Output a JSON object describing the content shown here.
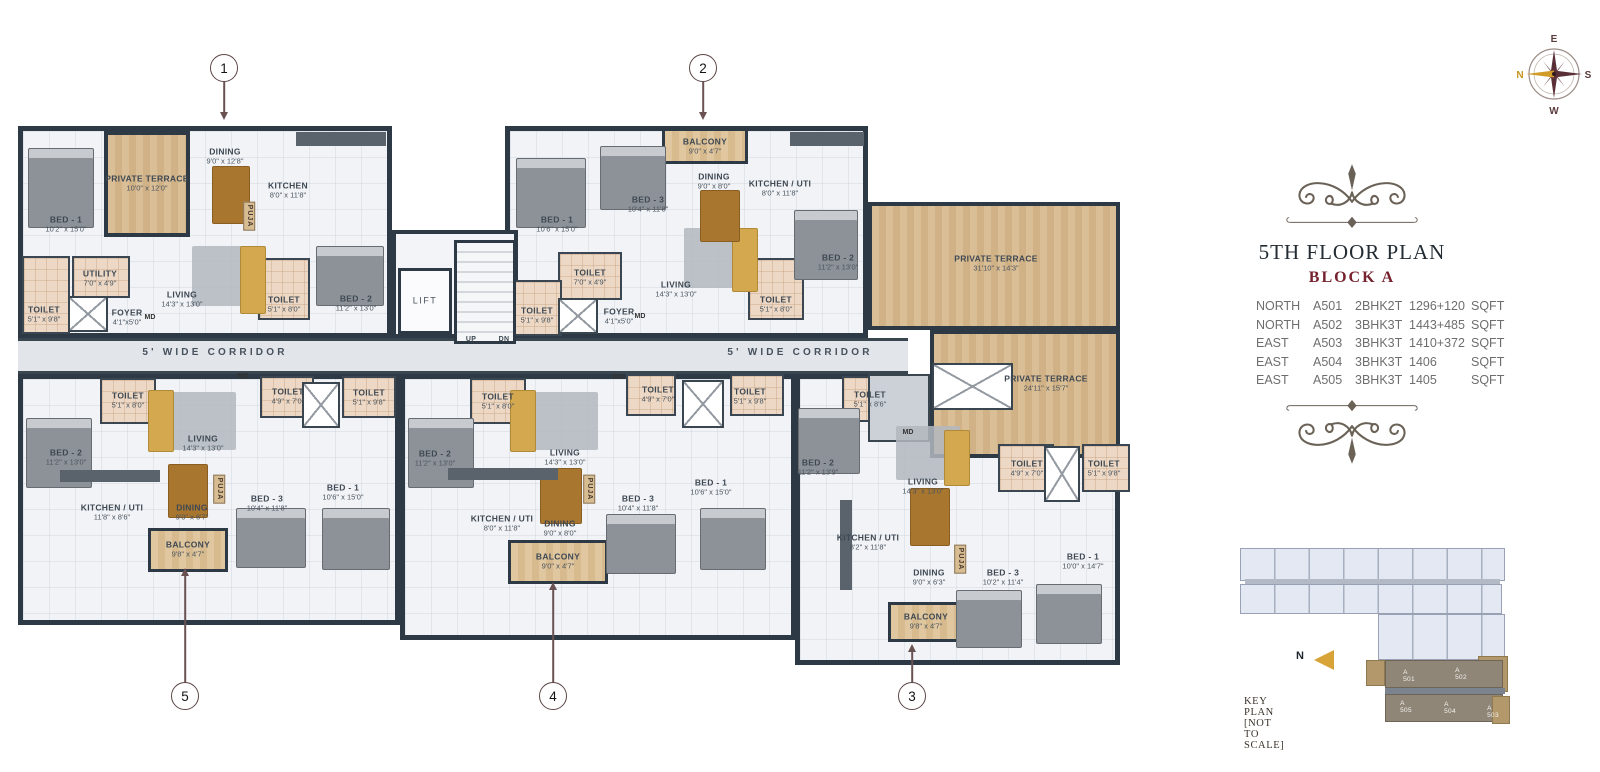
{
  "title": {
    "floor": "5TH FLOOR PLAN",
    "block": "BLOCK A"
  },
  "table": {
    "rows": [
      {
        "dir": "NORTH",
        "unit": "A501",
        "type": "2BHK2T",
        "area": "1296+120",
        "sqft": "SQFT"
      },
      {
        "dir": "NORTH",
        "unit": "A502",
        "type": "3BHK3T",
        "area": "1443+485",
        "sqft": "SQFT"
      },
      {
        "dir": "EAST",
        "unit": "A503",
        "type": "3BHK3T",
        "area": "1410+372",
        "sqft": "SQFT"
      },
      {
        "dir": "EAST",
        "unit": "A504",
        "type": "3BHK3T",
        "area": "1406",
        "sqft": "SQFT"
      },
      {
        "dir": "EAST",
        "unit": "A505",
        "type": "3BHK3T",
        "area": "1405",
        "sqft": "SQFT"
      }
    ]
  },
  "compass": {
    "n": "N",
    "e": "E",
    "s": "S",
    "w": "W"
  },
  "keyplan": {
    "caption": "KEY PLAN  [NOT TO SCALE]",
    "north_label": "N",
    "units": [
      {
        "label": "A 501",
        "x": 1409,
        "y": 676
      },
      {
        "label": "A 502",
        "x": 1461,
        "y": 674
      },
      {
        "label": "A 505",
        "x": 1406,
        "y": 707
      },
      {
        "label": "A 504",
        "x": 1450,
        "y": 708
      },
      {
        "label": "A 503",
        "x": 1493,
        "y": 712
      }
    ]
  },
  "colors": {
    "wall": "#2d3944",
    "terrace": "#d8bc92",
    "maroon": "#76232f",
    "gold": "#d19b2a"
  },
  "callouts": [
    {
      "n": "1",
      "cx": 224,
      "cy": 68,
      "x": 224,
      "y1": 82,
      "y2": 112,
      "head": "down"
    },
    {
      "n": "2",
      "cx": 703,
      "cy": 68,
      "x": 703,
      "y1": 82,
      "y2": 112,
      "head": "down"
    },
    {
      "n": "3",
      "cx": 912,
      "cy": 696,
      "x": 912,
      "y1": 652,
      "y2": 683,
      "head": "up"
    },
    {
      "n": "4",
      "cx": 553,
      "cy": 696,
      "x": 553,
      "y1": 590,
      "y2": 683,
      "head": "up"
    },
    {
      "n": "5",
      "cx": 185,
      "cy": 696,
      "x": 185,
      "y1": 576,
      "y2": 683,
      "head": "up"
    }
  ],
  "plan": {
    "md_text": "MD",
    "puja_text": "PUJA",
    "zones": [
      {
        "t": "unit",
        "x": 18,
        "y": 126,
        "w": 374,
        "h": 212
      },
      {
        "t": "unit",
        "x": 505,
        "y": 126,
        "w": 363,
        "h": 212
      },
      {
        "t": "unit",
        "x": 18,
        "y": 374,
        "w": 382,
        "h": 251
      },
      {
        "t": "unit",
        "x": 400,
        "y": 374,
        "w": 396,
        "h": 266
      },
      {
        "t": "unit",
        "x": 795,
        "y": 374,
        "w": 325,
        "h": 291
      },
      {
        "t": "core",
        "x": 392,
        "y": 230,
        "w": 126,
        "h": 108
      },
      {
        "t": "corridor",
        "x": 18,
        "y": 338,
        "w": 890,
        "h": 36
      },
      {
        "t": "terrace",
        "x": 868,
        "y": 202,
        "w": 252,
        "h": 128
      },
      {
        "t": "terrace",
        "x": 930,
        "y": 330,
        "w": 190,
        "h": 128
      },
      {
        "t": "terrace",
        "x": 104,
        "y": 131,
        "w": 86,
        "h": 106
      },
      {
        "t": "balcony",
        "x": 662,
        "y": 128,
        "w": 86,
        "h": 36
      },
      {
        "t": "balcony",
        "x": 148,
        "y": 528,
        "w": 80,
        "h": 44
      },
      {
        "t": "balcony",
        "x": 508,
        "y": 540,
        "w": 100,
        "h": 44
      },
      {
        "t": "balcony",
        "x": 888,
        "y": 602,
        "w": 76,
        "h": 40
      },
      {
        "t": "toilet",
        "x": 22,
        "y": 256,
        "w": 48,
        "h": 78
      },
      {
        "t": "toilet",
        "x": 72,
        "y": 256,
        "w": 58,
        "h": 42
      },
      {
        "t": "toilet",
        "x": 258,
        "y": 258,
        "w": 52,
        "h": 62
      },
      {
        "t": "toilet",
        "x": 558,
        "y": 252,
        "w": 64,
        "h": 48
      },
      {
        "t": "toilet",
        "x": 510,
        "y": 280,
        "w": 52,
        "h": 56
      },
      {
        "t": "toilet",
        "x": 748,
        "y": 258,
        "w": 56,
        "h": 62
      },
      {
        "t": "toilet",
        "x": 100,
        "y": 378,
        "w": 56,
        "h": 46
      },
      {
        "t": "toilet",
        "x": 260,
        "y": 376,
        "w": 54,
        "h": 42
      },
      {
        "t": "toilet",
        "x": 342,
        "y": 376,
        "w": 54,
        "h": 42
      },
      {
        "t": "toilet",
        "x": 470,
        "y": 378,
        "w": 56,
        "h": 46
      },
      {
        "t": "toilet",
        "x": 626,
        "y": 374,
        "w": 50,
        "h": 42
      },
      {
        "t": "toilet",
        "x": 730,
        "y": 374,
        "w": 54,
        "h": 42
      },
      {
        "t": "toilet",
        "x": 842,
        "y": 376,
        "w": 54,
        "h": 46
      },
      {
        "t": "toilet",
        "x": 998,
        "y": 444,
        "w": 56,
        "h": 48
      },
      {
        "t": "toilet",
        "x": 1082,
        "y": 444,
        "w": 48,
        "h": 48
      },
      {
        "t": "vest",
        "x": 868,
        "y": 374,
        "w": 62,
        "h": 68
      },
      {
        "t": "lift",
        "x": 398,
        "y": 268,
        "w": 54,
        "h": 66
      },
      {
        "t": "stairs",
        "x": 454,
        "y": 240,
        "w": 62,
        "h": 104
      },
      {
        "t": "duct",
        "x": 68,
        "y": 296,
        "w": 40,
        "h": 36
      },
      {
        "t": "duct",
        "x": 558,
        "y": 298,
        "w": 40,
        "h": 36
      },
      {
        "t": "duct",
        "x": 932,
        "y": 363,
        "w": 81,
        "h": 47
      },
      {
        "t": "duct",
        "x": 302,
        "y": 382,
        "w": 38,
        "h": 46
      },
      {
        "t": "duct",
        "x": 682,
        "y": 380,
        "w": 42,
        "h": 48
      },
      {
        "t": "duct",
        "x": 1044,
        "y": 446,
        "w": 36,
        "h": 56
      }
    ],
    "furniture": [
      {
        "t": "rug",
        "x": 192,
        "y": 246,
        "w": 62,
        "h": 60
      },
      {
        "t": "rug",
        "x": 684,
        "y": 228,
        "w": 64,
        "h": 60
      },
      {
        "t": "rug",
        "x": 170,
        "y": 392,
        "w": 66,
        "h": 58
      },
      {
        "t": "rug",
        "x": 532,
        "y": 392,
        "w": 66,
        "h": 58
      },
      {
        "t": "rug",
        "x": 896,
        "y": 426,
        "w": 64,
        "h": 54
      },
      {
        "t": "bed",
        "x": 28,
        "y": 148,
        "w": 64,
        "h": 78
      },
      {
        "t": "bed",
        "x": 316,
        "y": 246,
        "w": 66,
        "h": 58
      },
      {
        "t": "bed",
        "x": 516,
        "y": 158,
        "w": 68,
        "h": 68
      },
      {
        "t": "bed",
        "x": 600,
        "y": 146,
        "w": 64,
        "h": 62
      },
      {
        "t": "bed",
        "x": 794,
        "y": 210,
        "w": 62,
        "h": 68
      },
      {
        "t": "bed",
        "x": 26,
        "y": 418,
        "w": 64,
        "h": 68
      },
      {
        "t": "bed",
        "x": 236,
        "y": 508,
        "w": 68,
        "h": 58
      },
      {
        "t": "bed",
        "x": 322,
        "y": 508,
        "w": 66,
        "h": 60
      },
      {
        "t": "bed",
        "x": 408,
        "y": 418,
        "w": 64,
        "h": 68
      },
      {
        "t": "bed",
        "x": 606,
        "y": 514,
        "w": 68,
        "h": 58
      },
      {
        "t": "bed",
        "x": 700,
        "y": 508,
        "w": 64,
        "h": 60
      },
      {
        "t": "bed",
        "x": 798,
        "y": 408,
        "w": 60,
        "h": 64
      },
      {
        "t": "bed",
        "x": 956,
        "y": 590,
        "w": 64,
        "h": 56
      },
      {
        "t": "bed",
        "x": 1036,
        "y": 584,
        "w": 64,
        "h": 58
      },
      {
        "t": "sofa",
        "x": 240,
        "y": 246,
        "w": 24,
        "h": 66
      },
      {
        "t": "sofa",
        "x": 732,
        "y": 228,
        "w": 24,
        "h": 62
      },
      {
        "t": "sofa",
        "x": 148,
        "y": 390,
        "w": 24,
        "h": 60
      },
      {
        "t": "sofa",
        "x": 510,
        "y": 390,
        "w": 24,
        "h": 60
      },
      {
        "t": "sofa",
        "x": 944,
        "y": 430,
        "w": 24,
        "h": 54
      },
      {
        "t": "table",
        "x": 212,
        "y": 166,
        "w": 36,
        "h": 56
      },
      {
        "t": "table",
        "x": 700,
        "y": 190,
        "w": 38,
        "h": 50
      },
      {
        "t": "table",
        "x": 168,
        "y": 464,
        "w": 38,
        "h": 52
      },
      {
        "t": "table",
        "x": 540,
        "y": 468,
        "w": 40,
        "h": 54
      },
      {
        "t": "table",
        "x": 910,
        "y": 488,
        "w": 38,
        "h": 56
      },
      {
        "t": "counter",
        "x": 296,
        "y": 132,
        "w": 90,
        "h": 14
      },
      {
        "t": "counter",
        "x": 790,
        "y": 132,
        "w": 74,
        "h": 14
      },
      {
        "t": "counter",
        "x": 60,
        "y": 470,
        "w": 100,
        "h": 12
      },
      {
        "t": "counter",
        "x": 448,
        "y": 468,
        "w": 110,
        "h": 12
      },
      {
        "t": "counter",
        "x": 840,
        "y": 500,
        "w": 12,
        "h": 90
      }
    ],
    "labels": [
      {
        "name": "BED - 1",
        "dims": "10'2\" x 15'0\"",
        "x": 66,
        "y": 224
      },
      {
        "name": "PRIVATE TERRACE",
        "dims": "10'0\" x 12'0\"",
        "x": 147,
        "y": 183
      },
      {
        "name": "DINING",
        "dims": "9'0\" x 12'8\"",
        "x": 225,
        "y": 156
      },
      {
        "name": "KITCHEN",
        "dims": "8'0\" x 11'8\"",
        "x": 288,
        "y": 190
      },
      {
        "name": "UTILITY",
        "dims": "7'0\" x 4'9\"",
        "x": 100,
        "y": 278
      },
      {
        "name": "TOILET",
        "dims": "5'1\" x 9'8\"",
        "x": 44,
        "y": 314
      },
      {
        "name": "FOYER",
        "dims": "4'1\"x5'0\"",
        "x": 127,
        "y": 317
      },
      {
        "name": "LIVING",
        "dims": "14'3\" x 13'0\"",
        "x": 182,
        "y": 299
      },
      {
        "name": "TOILET",
        "dims": "5'1\" x 8'0\"",
        "x": 284,
        "y": 304
      },
      {
        "name": "BED - 2",
        "dims": "11'2\" x 13'0\"",
        "x": 356,
        "y": 303
      },
      {
        "name": "BED - 1",
        "dims": "10'6\" x 15'0\"",
        "x": 557,
        "y": 224
      },
      {
        "name": "BED - 3",
        "dims": "10'4\" x 11'8\"",
        "x": 648,
        "y": 204
      },
      {
        "name": "BALCONY",
        "dims": "9'0\" x 4'7\"",
        "x": 705,
        "y": 146
      },
      {
        "name": "DINING",
        "dims": "9'0\" x 8'0\"",
        "x": 714,
        "y": 181
      },
      {
        "name": "KITCHEN / UTI",
        "dims": "8'0\" x 11'8\"",
        "x": 780,
        "y": 188
      },
      {
        "name": "TOILET",
        "dims": "7'0\" x 4'9\"",
        "x": 590,
        "y": 277
      },
      {
        "name": "TOILET",
        "dims": "5'1\" x 9'8\"",
        "x": 537,
        "y": 315
      },
      {
        "name": "FOYER",
        "dims": "4'1\"x5'0\"",
        "x": 619,
        "y": 316
      },
      {
        "name": "LIVING",
        "dims": "14'3\" x 13'0\"",
        "x": 676,
        "y": 289
      },
      {
        "name": "TOILET",
        "dims": "5'1\" x 8'0\"",
        "x": 776,
        "y": 304
      },
      {
        "name": "BED - 2",
        "dims": "11'2\" x 13'0\"",
        "x": 838,
        "y": 262
      },
      {
        "name": "PRIVATE TERRACE",
        "dims": "31'10\" x 14'3\"",
        "x": 996,
        "y": 263
      },
      {
        "name": "PRIVATE TERRACE",
        "dims": "24'11\" x 15'7\"",
        "x": 1046,
        "y": 383
      },
      {
        "name": "TOILET",
        "dims": "5'1\" x 8'0\"",
        "x": 128,
        "y": 400
      },
      {
        "name": "LIVING",
        "dims": "14'3\" x 13'0\"",
        "x": 203,
        "y": 443
      },
      {
        "name": "TOILET",
        "dims": "4'9\" x 7'0\"",
        "x": 288,
        "y": 396
      },
      {
        "name": "TOILET",
        "dims": "5'1\" x 9'8\"",
        "x": 369,
        "y": 397
      },
      {
        "name": "BED - 2",
        "dims": "11'2\" x 13'0\"",
        "x": 66,
        "y": 457
      },
      {
        "name": "KITCHEN / UTI",
        "dims": "11'8\" x 8'6\"",
        "x": 112,
        "y": 512
      },
      {
        "name": "DINING",
        "dims": "9'0\" x 6'7\"",
        "x": 192,
        "y": 512
      },
      {
        "name": "BALCONY",
        "dims": "9'8\" x 4'7\"",
        "x": 188,
        "y": 549
      },
      {
        "name": "BED - 3",
        "dims": "10'4\" x 11'8\"",
        "x": 267,
        "y": 503
      },
      {
        "name": "BED - 1",
        "dims": "10'6\" x 15'0\"",
        "x": 343,
        "y": 492
      },
      {
        "name": "TOILET",
        "dims": "5'1\" x 8'0\"",
        "x": 498,
        "y": 401
      },
      {
        "name": "LIVING",
        "dims": "14'3\" x 13'0\"",
        "x": 565,
        "y": 457
      },
      {
        "name": "TOILET",
        "dims": "4'9\" x 7'0\"",
        "x": 658,
        "y": 394
      },
      {
        "name": "TOILET",
        "dims": "5'1\" x 9'8\"",
        "x": 750,
        "y": 396
      },
      {
        "name": "BED - 2",
        "dims": "11'2\" x 13'0\"",
        "x": 435,
        "y": 458
      },
      {
        "name": "KITCHEN / UTI",
        "dims": "8'0\" x 11'8\"",
        "x": 502,
        "y": 523
      },
      {
        "name": "DINING",
        "dims": "9'0\" x 8'0\"",
        "x": 560,
        "y": 528
      },
      {
        "name": "BALCONY",
        "dims": "9'0\" x 4'7\"",
        "x": 558,
        "y": 561
      },
      {
        "name": "BED - 3",
        "dims": "10'4\" x 11'8\"",
        "x": 638,
        "y": 503
      },
      {
        "name": "BED - 1",
        "dims": "10'6\" x 15'0\"",
        "x": 711,
        "y": 487
      },
      {
        "name": "BED - 2",
        "dims": "11'2\" x 13'9\"",
        "x": 818,
        "y": 467
      },
      {
        "name": "TOILET",
        "dims": "5'1\" x 8'6\"",
        "x": 870,
        "y": 399
      },
      {
        "name": "LIVING",
        "dims": "14'3\" x 13'0\"",
        "x": 923,
        "y": 486
      },
      {
        "name": "TOILET",
        "dims": "4'9\" x 7'0\"",
        "x": 1027,
        "y": 468
      },
      {
        "name": "TOILET",
        "dims": "5'1\" x 9'8\"",
        "x": 1104,
        "y": 468
      },
      {
        "name": "KITCHEN / UTI",
        "dims": "8'2\" x 11'8\"",
        "x": 868,
        "y": 542
      },
      {
        "name": "DINING",
        "dims": "9'0\" x 6'3\"",
        "x": 929,
        "y": 577
      },
      {
        "name": "BALCONY",
        "dims": "9'8\" x 4'7\"",
        "x": 926,
        "y": 621
      },
      {
        "name": "BED - 3",
        "dims": "10'2\" x 11'4\"",
        "x": 1003,
        "y": 577
      },
      {
        "name": "BED - 1",
        "dims": "10'0\" x 14'7\"",
        "x": 1083,
        "y": 561
      },
      {
        "name": "LIFT",
        "x": 425,
        "y": 301,
        "cls": "lift"
      },
      {
        "name": "UP",
        "x": 471,
        "y": 340,
        "cls": "tiny"
      },
      {
        "name": "DN",
        "x": 504,
        "y": 340,
        "cls": "tiny"
      },
      {
        "name": "5' WIDE CORRIDOR",
        "x": 215,
        "y": 353,
        "cls": "corr"
      },
      {
        "name": "5' WIDE CORRIDOR",
        "x": 800,
        "y": 353,
        "cls": "corr"
      }
    ],
    "md_positions": [
      [
        150,
        318
      ],
      [
        640,
        317
      ],
      [
        243,
        377
      ],
      [
        619,
        378
      ],
      [
        908,
        433
      ]
    ],
    "puja_positions": [
      [
        249,
        216
      ],
      [
        219,
        489
      ],
      [
        589,
        489
      ],
      [
        960,
        559
      ]
    ]
  }
}
